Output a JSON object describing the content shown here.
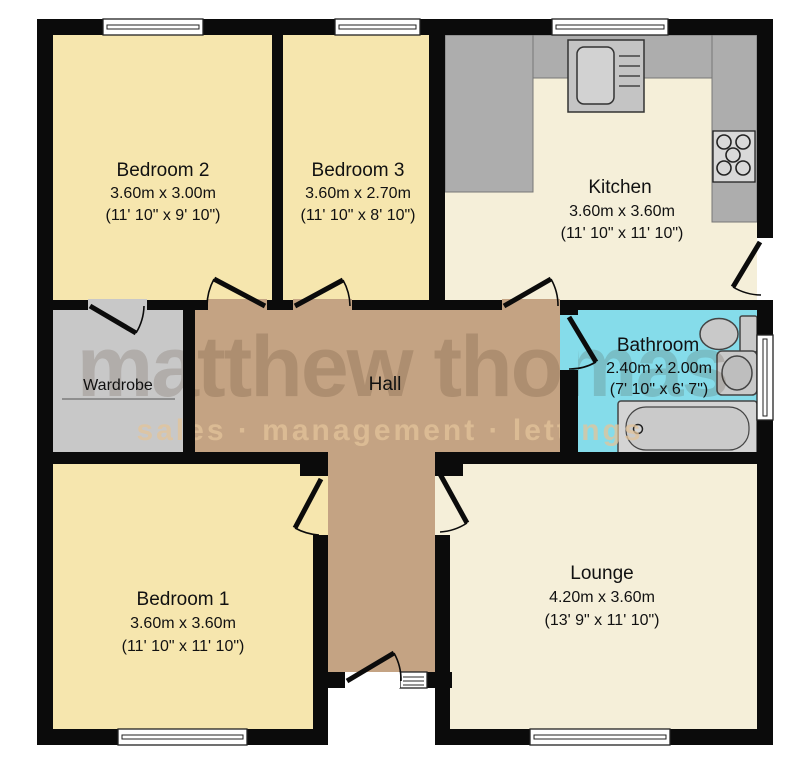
{
  "title": "Bungalow floor plan",
  "watermark": {
    "line1": "matthew thomas",
    "line2": "sales · management · lettings"
  },
  "rooms": [
    {
      "id": "bedroom2",
      "name": "Bedroom 2",
      "metric": "3.60m x 3.00m",
      "imperial": "(11' 10\" x 9' 10\")"
    },
    {
      "id": "bedroom3",
      "name": "Bedroom 3",
      "metric": "3.60m x 2.70m",
      "imperial": "(11' 10\" x 8' 10\")"
    },
    {
      "id": "kitchen",
      "name": "Kitchen",
      "metric": "3.60m x 3.60m",
      "imperial": "(11' 10\" x 11' 10\")"
    },
    {
      "id": "bathroom",
      "name": "Bathroom",
      "metric": "2.40m x 2.00m",
      "imperial": "(7' 10\" x 6' 7\")"
    },
    {
      "id": "wardrobe",
      "name": "Wardrobe"
    },
    {
      "id": "hall",
      "name": "Hall"
    },
    {
      "id": "bedroom1",
      "name": "Bedroom 1",
      "metric": "3.60m x 3.60m",
      "imperial": "(11' 10\" x 11' 10\")"
    },
    {
      "id": "lounge",
      "name": "Lounge",
      "metric": "4.20m x 3.60m",
      "imperial": "(13' 9\" x 11' 10\")"
    }
  ],
  "fixtures": {
    "kitchen": [
      "sink-unit",
      "drainer",
      "hob"
    ],
    "bathroom": [
      "toilet",
      "basin",
      "bathtub"
    ],
    "wardrobe": [
      "shelf-rail"
    ]
  },
  "colors": {
    "bedroom_fill": "#f6e6ae",
    "living_fill": "#f5efd9",
    "hall_fill": "#c4a383",
    "wardrobe_fill": "#c8c8c8",
    "bathroom_fill": "#85dcea",
    "wall": "#0b0b0b",
    "counter": "#adadad",
    "fixture": "#c9c9c9",
    "watermark_dark": "#3c2814",
    "watermark_accent": "#e3c49a"
  },
  "window_count": 6,
  "door_count": 9
}
